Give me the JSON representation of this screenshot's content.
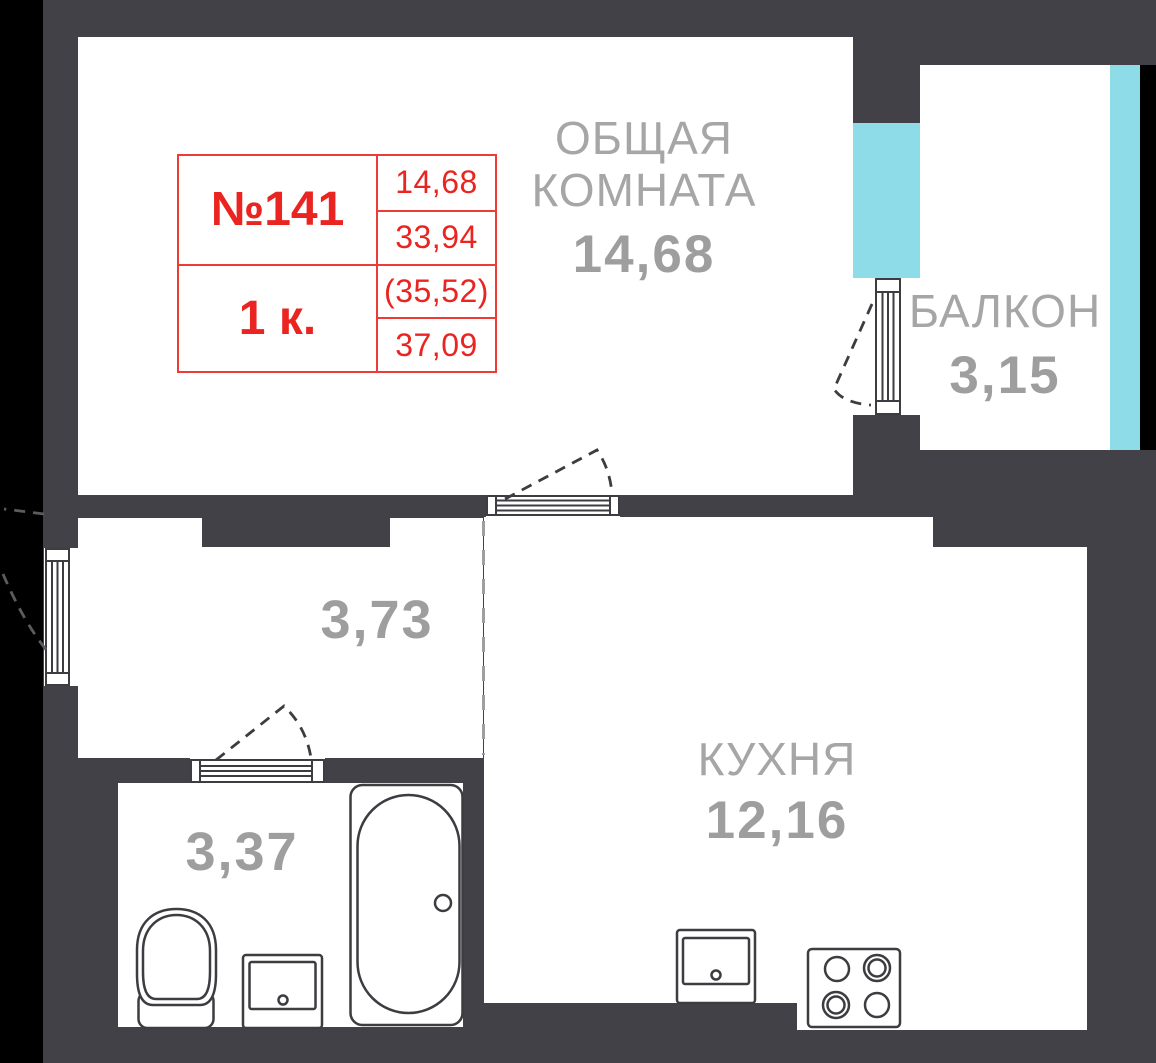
{
  "plan_title": "Apartment floor plan",
  "info_table": {
    "apartment_number": "№141",
    "rooms_count": "1 к.",
    "values": [
      "14,68",
      "33,94",
      "(35,52)",
      "37,09"
    ]
  },
  "rooms": {
    "living": {
      "name": "ОБЩАЯ КОМНАТА",
      "area": "14,68"
    },
    "balcony": {
      "name": "БАЛКОН",
      "area": "3,15"
    },
    "kitchen": {
      "name": "КУХНЯ",
      "area": "12,16"
    },
    "hallway": {
      "area": "3,73"
    },
    "bathroom": {
      "area": "3,37"
    }
  },
  "colors": {
    "wall": "#414147",
    "room_fill": "#ffffff",
    "window_glass": "#8fdce9",
    "exterior_edge": "#000000",
    "label_gray": "#a6a6a6",
    "accent_red": "#ea2420",
    "line_dark": "#3c3c41"
  }
}
